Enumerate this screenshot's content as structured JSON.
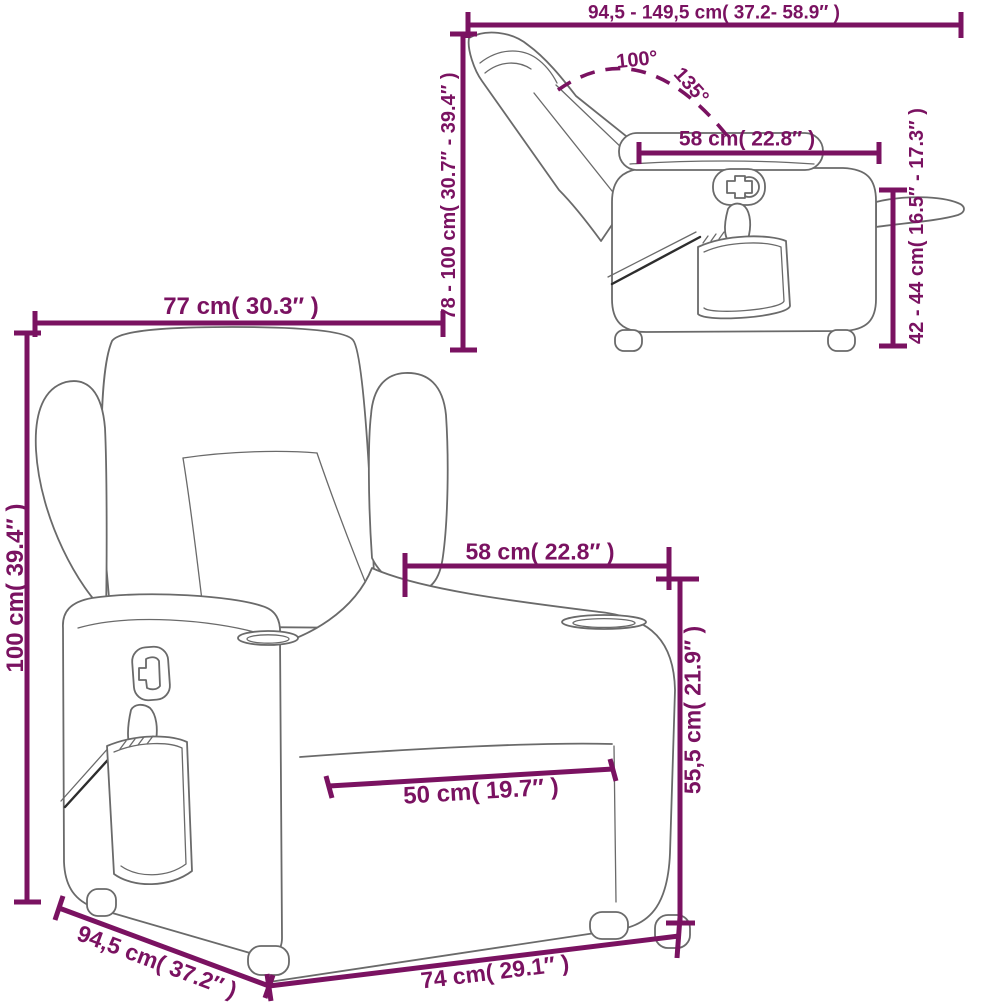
{
  "figure": {
    "title": "recliner chair dimension diagram",
    "colors": {
      "dimension_color": "#7a1261",
      "line_color": "#6a6a6a",
      "dark_line_color": "#2d2d2d",
      "background": "#ffffff"
    },
    "side_view": {
      "description": "reclined side view of chair",
      "labels": {
        "width_range": "94,5 - 149,5 cm( 37.2- 58.9″ )",
        "recline_angle_min": "100°",
        "recline_angle_max": "135°",
        "armrest_length": "58 cm( 22.8″ )",
        "height_range": "78 - 100 cm( 30.7″ - 39.4″ )",
        "footrest_height_range": "42 - 44 cm( 16.5″ - 17.3″ )"
      }
    },
    "front_view": {
      "description": "three-quarter front view of chair",
      "labels": {
        "overall_width": "77 cm( 30.3″ )",
        "overall_height": "100 cm( 39.4″ )",
        "backrest_width": "58 cm( 22.8″ )",
        "seat_height": "55,5 cm( 21.9″ )",
        "seat_width": "50 cm( 19.7″ )",
        "depth": "94,5 cm( 37.2″ )",
        "base_width": "74 cm( 29.1″ )"
      }
    }
  }
}
